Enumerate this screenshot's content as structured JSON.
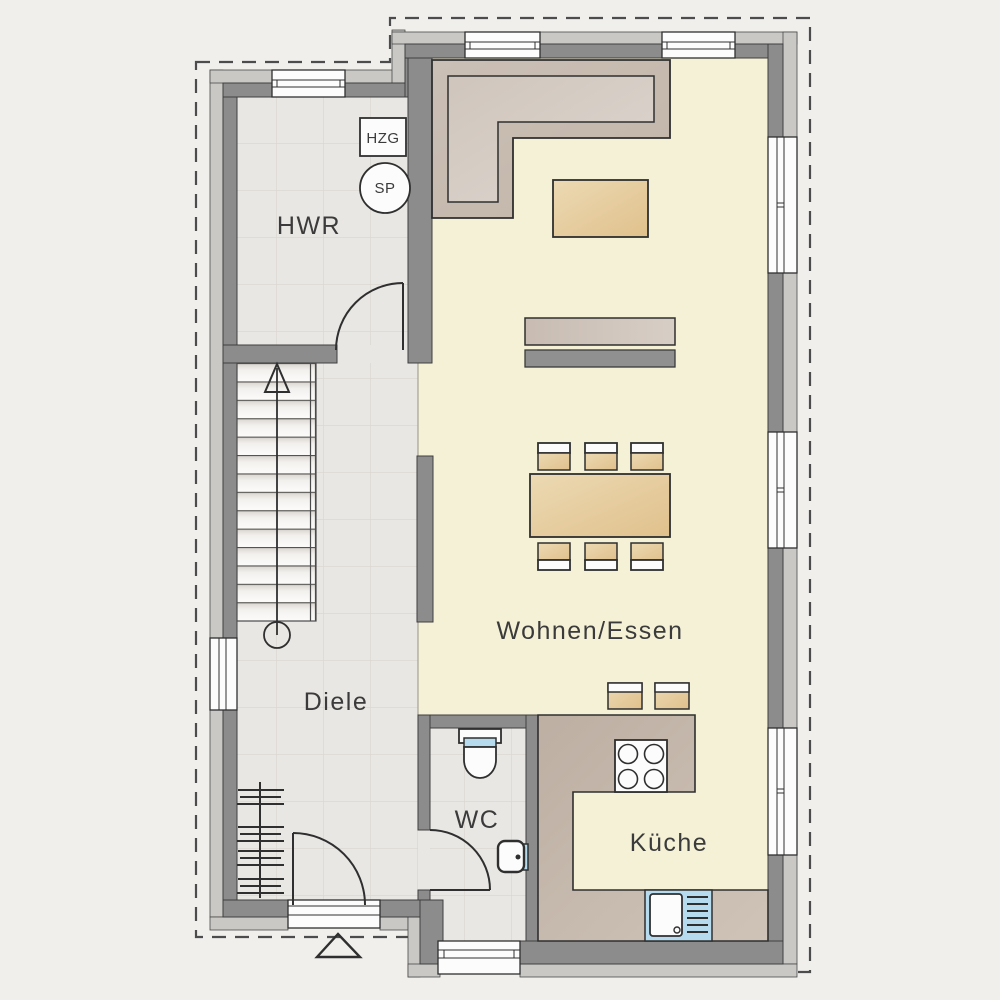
{
  "rooms": {
    "hwr": {
      "label": "HWR"
    },
    "diele": {
      "label": "Diele"
    },
    "wc": {
      "label": "WC"
    },
    "kueche": {
      "label": "Küche"
    },
    "wohnen_essen": {
      "label": "Wohnen/Essen"
    }
  },
  "equipment": {
    "hzg": {
      "label": "HZG"
    },
    "sp": {
      "label": "SP"
    }
  },
  "symbols": [
    "staircase-with-up-arrow",
    "entrance-triangle-marker",
    "coat-rack",
    "l-shaped-sofa",
    "coffee-table",
    "sideboard",
    "tv-board",
    "dining-table-6-chairs",
    "bar-stools",
    "stove-4-burner",
    "kitchen-sink-with-drainer",
    "toilet",
    "hand-basin",
    "windows",
    "door-swings",
    "roof-overhang-dashed-line"
  ],
  "colors": {
    "bg": "#f0efec",
    "floor-gray": "#e9e7e3",
    "floor-grid": "#d9d5d0",
    "floor-yellow": "#f5f1d6",
    "wall-dark": "#8c8c8c",
    "wall-light": "#c9c8c5",
    "outline": "#2f2f2f",
    "taupe-dark": "#bdafa2",
    "taupe-light": "#d3c9c0",
    "wood-dark": "#e0c18c",
    "wood-light": "#ecd9b3",
    "fixture-blue": "#b7dbee",
    "white": "#fcfcfc",
    "dash": "#4c4c4c",
    "text": "#3b3b3b",
    "tv-gray": "#909090"
  }
}
